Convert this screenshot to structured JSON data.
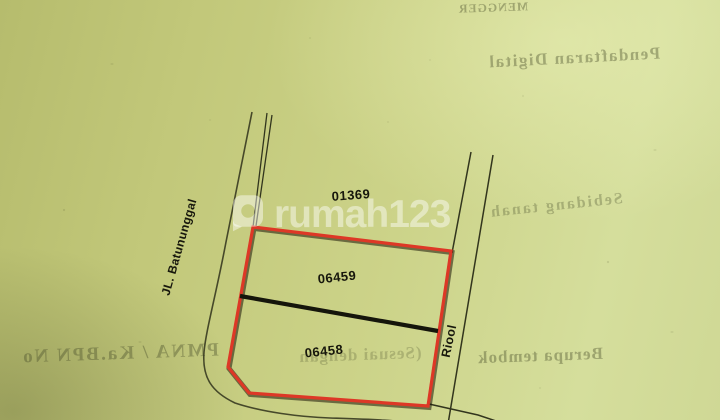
{
  "map": {
    "parcel_top_id": "01369",
    "parcel_upper_id": "06459",
    "parcel_lower_id": "06458",
    "street_left": "JL. Batununggal",
    "channel_right": "Riool",
    "highlight_color": "#dd3826",
    "line_color": "#373a20",
    "paper_color": "#ccd389"
  },
  "watermark": {
    "brand": "rumah123",
    "icon": "location-pin",
    "color": "#ffffff"
  },
  "bleed_through_back_page": {
    "line1": "MENGGER",
    "line2": "Pendaftaran Digital",
    "line3": "Sebidang tanah",
    "line4_right": "Berupa tembok",
    "line4_mid": "(Sesuai dengan",
    "line4_left": "PMNA / Ka.BPN No"
  }
}
